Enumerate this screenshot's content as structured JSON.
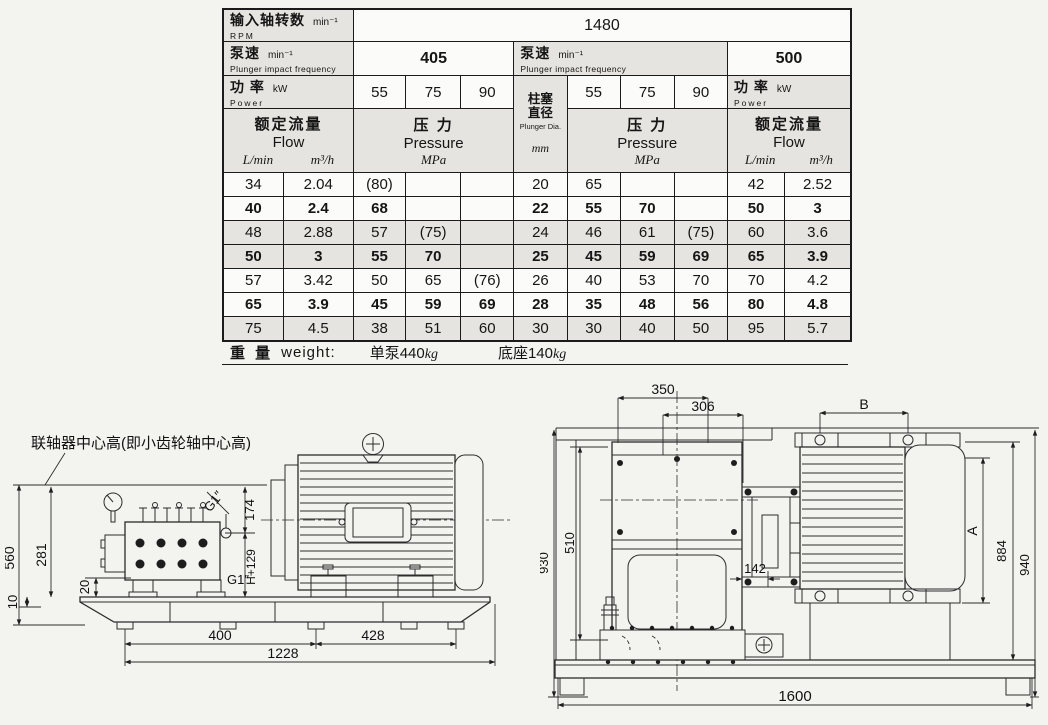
{
  "table": {
    "input_shaft": {
      "zh": "输入轴转数",
      "unit": "min⁻¹",
      "en": "RPM",
      "value": "1480"
    },
    "pump_speed_left": {
      "zh": "泵速",
      "unit": "min⁻¹",
      "en": "Plunger impact frequency",
      "value": "405"
    },
    "pump_speed_right": {
      "zh": "泵速",
      "unit": "min⁻¹",
      "en": "Plunger impact frequency",
      "value": "500"
    },
    "power_left": {
      "zh": "功 率",
      "unit": "kW",
      "en": "Power",
      "cols": [
        "55",
        "75",
        "90"
      ]
    },
    "power_right": {
      "zh": "功 率",
      "unit": "kW",
      "en": "Power",
      "cols": [
        "55",
        "75",
        "90"
      ]
    },
    "flow_left": {
      "zh": "额定流量",
      "en": "Flow",
      "unit1": "L/min",
      "unit2": "m³/h"
    },
    "flow_right": {
      "zh": "额定流量",
      "en": "Flow",
      "unit1": "L/min",
      "unit2": "m³/h"
    },
    "pressure_left": {
      "zh": "压 力",
      "en": "Pressure",
      "unit": "MPa"
    },
    "pressure_right": {
      "zh": "压 力",
      "en": "Pressure",
      "unit": "MPa"
    },
    "plunger": {
      "zh1": "柱塞",
      "zh2": "直径",
      "en": "Plunger Dia.",
      "unit": "mm"
    },
    "rows": [
      {
        "style": "plain",
        "cells": [
          "34",
          "2.04",
          "(80)",
          "",
          "",
          "20",
          "65",
          "",
          "",
          "42",
          "2.52"
        ]
      },
      {
        "style": "bold",
        "cells": [
          "40",
          "2.4",
          "68",
          "",
          "",
          "22",
          "55",
          "70",
          "",
          "50",
          "3"
        ]
      },
      {
        "style": "shaded",
        "cells": [
          "48",
          "2.88",
          "57",
          "(75)",
          "",
          "24",
          "46",
          "61",
          "(75)",
          "60",
          "3.6"
        ]
      },
      {
        "style": "bold shaded",
        "cells": [
          "50",
          "3",
          "55",
          "70",
          "",
          "25",
          "45",
          "59",
          "69",
          "65",
          "3.9"
        ]
      },
      {
        "style": "plain",
        "cells": [
          "57",
          "3.42",
          "50",
          "65",
          "(76)",
          "26",
          "40",
          "53",
          "70",
          "70",
          "4.2"
        ]
      },
      {
        "style": "bold",
        "cells": [
          "65",
          "3.9",
          "45",
          "59",
          "69",
          "28",
          "35",
          "48",
          "56",
          "80",
          "4.8"
        ]
      },
      {
        "style": "shaded",
        "cells": [
          "75",
          "4.5",
          "38",
          "51",
          "60",
          "30",
          "30",
          "40",
          "50",
          "95",
          "5.7"
        ]
      }
    ],
    "weight": {
      "zh": "重 量",
      "en": "weight:",
      "item1": "单泵440",
      "unit1": "kg",
      "item2": "底座140",
      "unit2": "kg"
    }
  },
  "left_drawing": {
    "callout": "联轴器中心高(即小齿轮轴中心高)",
    "dims": {
      "height_overall": "560",
      "height_center": "281",
      "pad": "20",
      "shim": "10",
      "v174": "174",
      "vh129": "H+129",
      "port_top": "G1″",
      "port_side": "G1″",
      "span1": "400",
      "span2": "428",
      "span_total": "1228"
    }
  },
  "right_drawing": {
    "dims": {
      "top1": "350",
      "top2": "306",
      "motor_b": "B",
      "frame_h": "930",
      "gear_h": "510",
      "coupling": "142",
      "motor_a": "A",
      "h884": "884",
      "h940": "940",
      "base_w": "1600"
    }
  }
}
